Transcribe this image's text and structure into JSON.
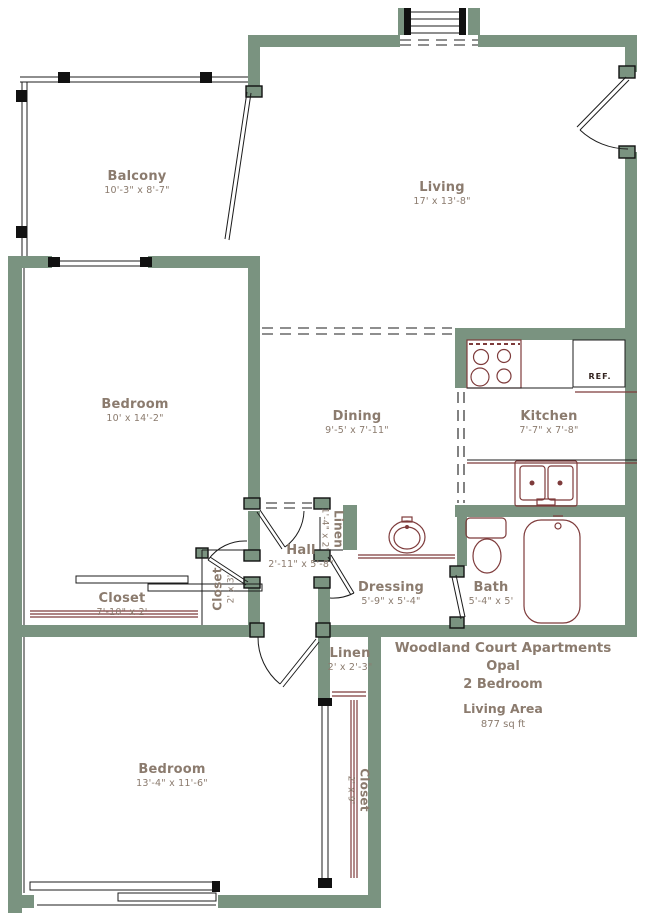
{
  "rooms": {
    "balcony": {
      "name": "Balcony",
      "dims": "10'-3\" x 8'-7\""
    },
    "living": {
      "name": "Living",
      "dims": "17' x 13'-8\""
    },
    "bedroom1": {
      "name": "Bedroom",
      "dims": "10' x 14'-2\""
    },
    "dining": {
      "name": "Dining",
      "dims": "9'-5' x 7'-11\""
    },
    "kitchen": {
      "name": "Kitchen",
      "dims": "7'-7\" x 7'-8\""
    },
    "hall": {
      "name": "Hall",
      "dims": "2'-11\" x 5'-8\""
    },
    "linen_hall": {
      "name": "Linen",
      "dims": "1'-4\" x 2'"
    },
    "closet_bedroom1": {
      "name": "Closet",
      "dims": "7'-10\" x 2'"
    },
    "closet_hall": {
      "name": "Closet",
      "dims": "2' x 3'"
    },
    "dressing": {
      "name": "Dressing",
      "dims": "5'-9\" x 5'-4\""
    },
    "bath": {
      "name": "Bath",
      "dims": "5'-4\" x 5'"
    },
    "linen_bedroom2": {
      "name": "Linen",
      "dims": "2' x 2'-3\""
    },
    "bedroom2": {
      "name": "Bedroom",
      "dims": "13'-4\" x 11'-6\""
    },
    "closet_bedroom2": {
      "name": "Closet",
      "dims": "2' x 9'"
    }
  },
  "appliances": {
    "refrigerator": "REF."
  },
  "title_block": {
    "community": "Woodland Court Apartments",
    "unit_name": "Opal",
    "unit_type": "2 Bedroom",
    "area_label": "Living Area",
    "area_value": "877 sq ft"
  },
  "colors": {
    "wall": "#7a9380",
    "fixture": "#7e3b3b",
    "label_text": "#8b7b6e",
    "line": "#1c1c1c"
  }
}
